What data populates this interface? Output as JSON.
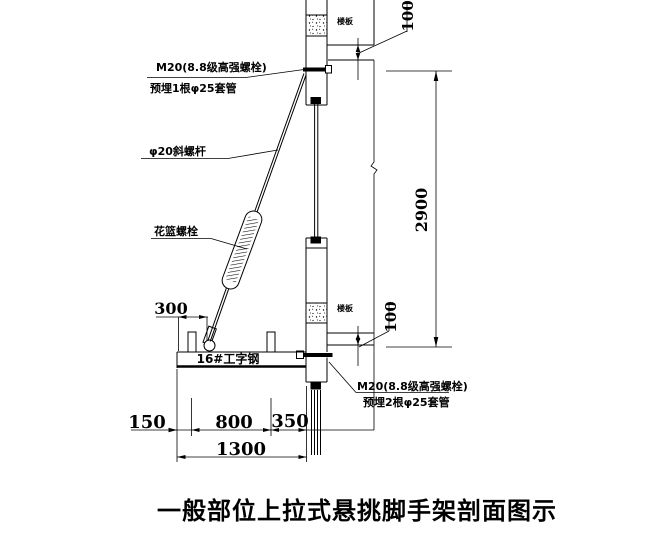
{
  "drawing": {
    "title": "一般部位上拉式悬挑脚手架剖面图示",
    "labels": {
      "upper_anchor_line1": "M20(8.8级高强螺栓)",
      "upper_anchor_line2": "预埋1根φ25套管",
      "diagonal_rod": "φ20斜螺杆",
      "turnbuckle": "花篮螺栓",
      "i_beam": "16#工字钢",
      "lower_anchor_line1": "M20(8.8级高强螺栓)",
      "lower_anchor_line2": "预埋2根φ25套管",
      "upper_floor_slab": "楼板",
      "lower_floor_slab": "楼板"
    },
    "dimensions": {
      "upper_slab_thickness": "100",
      "story_height": "2900",
      "lower_slab_thickness": "100",
      "lug_offset": "300",
      "overhang_seg1": "150",
      "overhang_seg2": "800",
      "overhang_seg3": "350",
      "overhang_total": "1300"
    },
    "line_color": "#000000",
    "background_color": "#ffffff"
  }
}
